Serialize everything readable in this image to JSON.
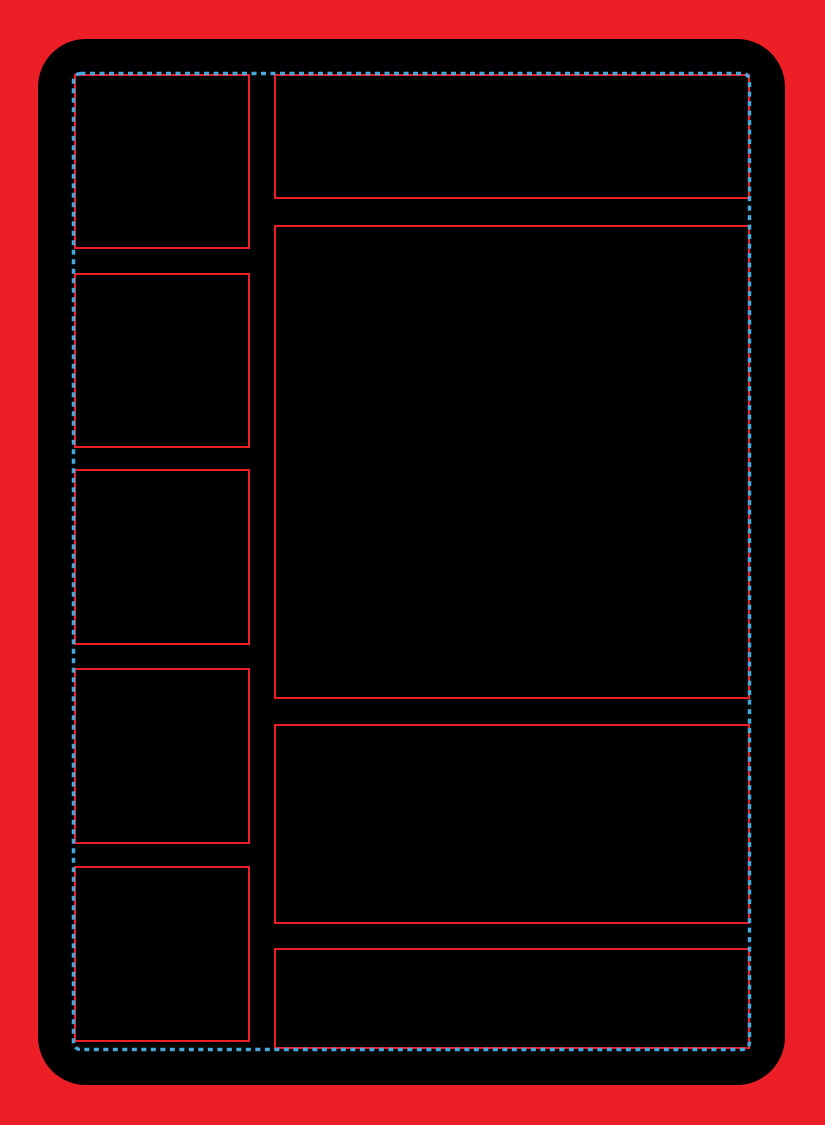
{
  "template": {
    "kind": "card-layout-template",
    "visible_text": "",
    "left_column": {
      "slot_count": 5,
      "slots": [
        {
          "name": "left-slot-1"
        },
        {
          "name": "left-slot-2"
        },
        {
          "name": "left-slot-3"
        },
        {
          "name": "left-slot-4"
        },
        {
          "name": "left-slot-5"
        }
      ]
    },
    "right_column": {
      "panel_count": 4,
      "panels": [
        {
          "name": "header-panel"
        },
        {
          "name": "main-panel"
        },
        {
          "name": "body-panel"
        },
        {
          "name": "footer-panel"
        }
      ]
    }
  },
  "colors": {
    "bleed_red": "#EC1F27",
    "card_black": "#000000",
    "panel_border_red": "#EC1F27",
    "guide_blue": "#47A8DC"
  },
  "guide": {
    "style": "dashed",
    "dash_length": 5,
    "dash_gap": 4.5
  }
}
